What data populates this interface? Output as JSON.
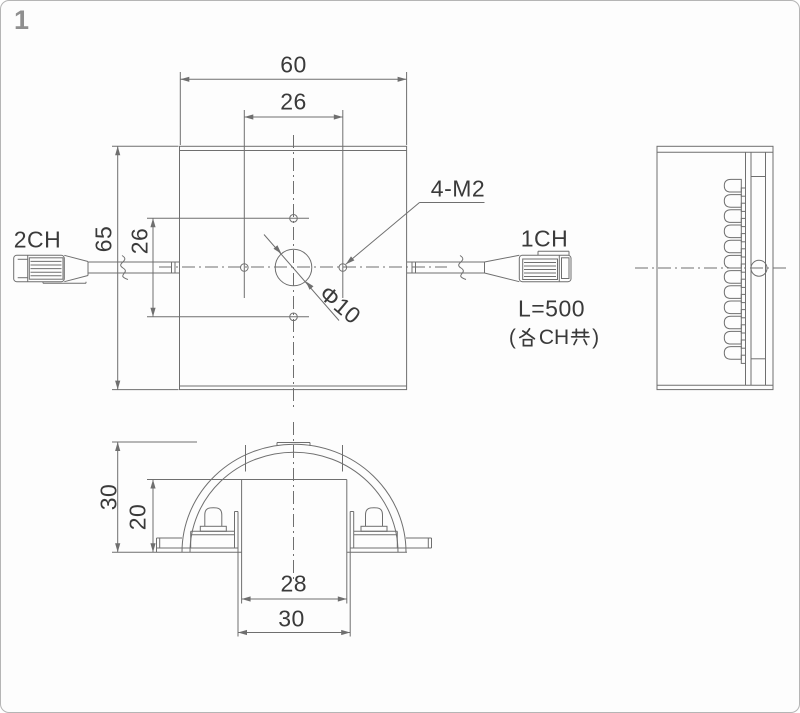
{
  "page": {
    "number": "1"
  },
  "colors": {
    "line": "#6f6f6f",
    "text": "#3a3a3a",
    "page_number": "#8f8f8f",
    "border": "#b5b5b5",
    "background": "#fdfdfd"
  },
  "views": {
    "front": {
      "dims": {
        "overall_width": "60",
        "hole_pitch_horizontal": "26",
        "overall_height": "65",
        "hole_pitch_vertical": "26"
      },
      "labels": {
        "mounting_holes_callout": "4-M2",
        "center_hole_diameter": "Φ10"
      }
    },
    "bottom": {
      "dims": {
        "dome_height": "30",
        "inner_opening_height": "20",
        "inner_opening_width": "28",
        "outer_opening_width": "30"
      }
    }
  },
  "cables": {
    "left_channel_label": "2CH",
    "right_channel_label": "1CH",
    "length_note": "L=500",
    "channel_note_full": "（各CH共）",
    "note_parts": {
      "open": "(",
      "kanji_each": "各",
      "ch_text": "CH",
      "kanji_common": "共",
      "close": ")"
    }
  }
}
